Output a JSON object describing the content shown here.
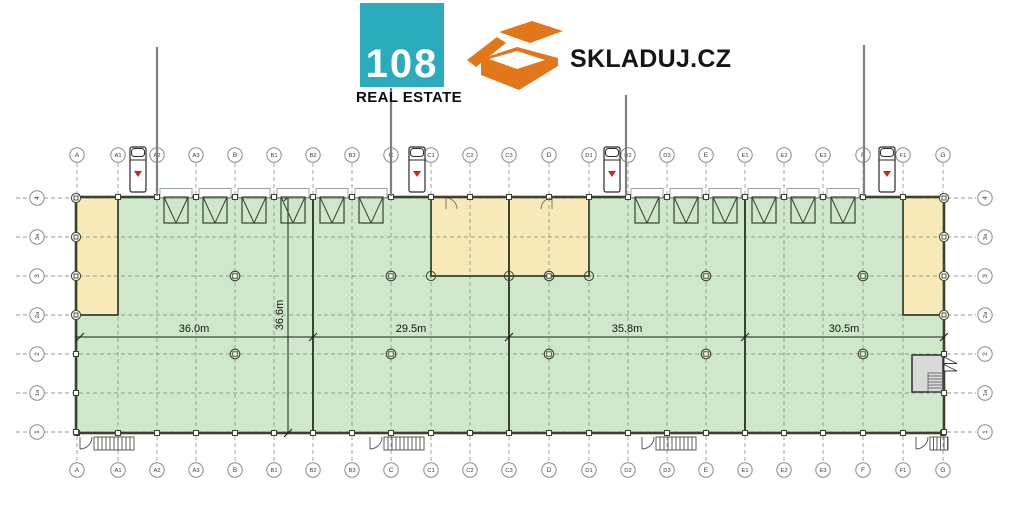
{
  "header": {
    "logo108": {
      "number": "108",
      "subtitle": "REAL ESTATE",
      "bg_color": "#2babbb"
    },
    "skladuj": {
      "label": "SKLADUJ.CZ",
      "box_color": "#e2761b"
    },
    "watermark": "ala"
  },
  "plan": {
    "grid_columns": [
      "A",
      "A1",
      "A2",
      "A3",
      "B",
      "B1",
      "B2",
      "B3",
      "C",
      "C1",
      "C2",
      "C3",
      "D",
      "D1",
      "D2",
      "D3",
      "E",
      "E1",
      "E2",
      "E3",
      "F",
      "F1",
      "G"
    ],
    "grid_rows": [
      "4",
      "3a",
      "3",
      "2a",
      "2",
      "1a",
      "1"
    ],
    "dim_horizontal": [
      "36.0m",
      "29.5m",
      "35.8m",
      "30.5m"
    ],
    "dim_vertical": "36.6m",
    "colors": {
      "hall_fill": "#cfe7cb",
      "office_fill": "#f7eab8",
      "tech_room_fill": "#d9d9d9",
      "wall": "#3a4331",
      "truck_marker_red": "#c62828",
      "grid_line": "#8fa08f"
    }
  }
}
